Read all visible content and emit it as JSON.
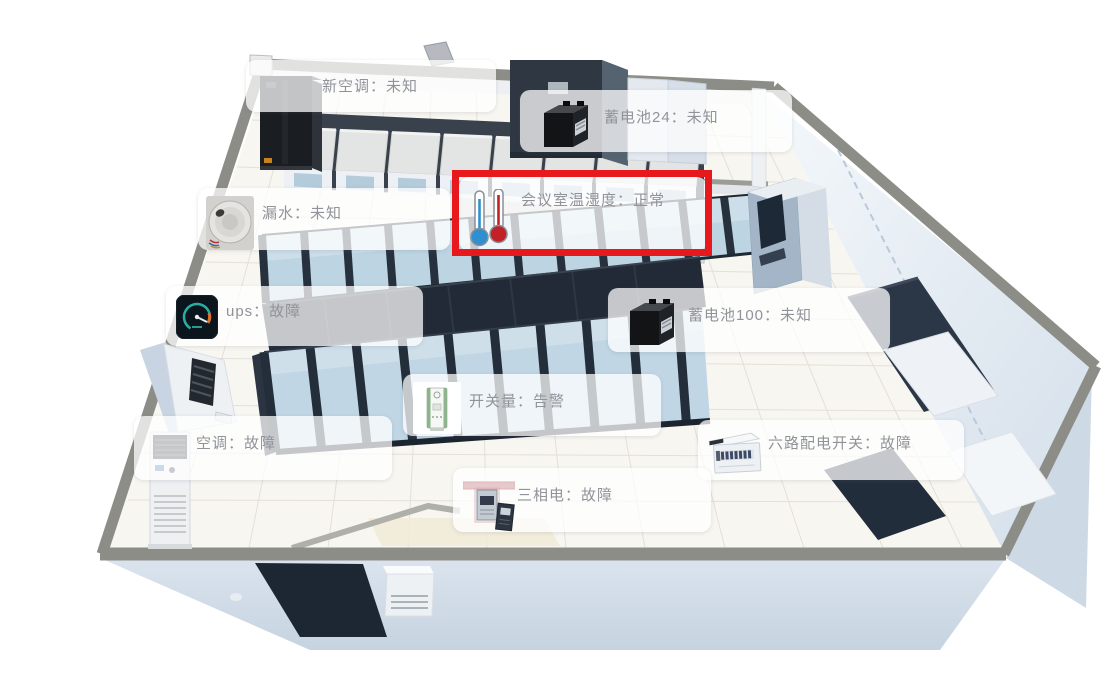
{
  "view": {
    "kind": "machine-room-3d-monitor"
  },
  "colors": {
    "highlight_box": "#e8191c",
    "label_text": "#909399",
    "wall_edge": "#8d8d87",
    "rack_frame": "#27313d",
    "rack_glass": "#bdd4e2",
    "status_normal_thermo_blue": "#2f8fd0",
    "status_normal_thermo_red": "#c22127"
  },
  "highlight": {
    "target": "会议室温湿度",
    "color": "#e8191c"
  },
  "devices": [
    {
      "name": "新空调",
      "status": "未知",
      "label": "新空调：未知",
      "icon": "tower-ac-icon"
    },
    {
      "name": "蓄电池24",
      "status": "未知",
      "label": "蓄电池24：未知",
      "icon": "battery-icon"
    },
    {
      "name": "会议室温湿度",
      "status": "正常",
      "label": "会议室温湿度：正常",
      "icon": "thermometer-pair-icon",
      "highlighted": true
    },
    {
      "name": "漏水",
      "status": "未知",
      "label": "漏水：未知",
      "icon": "leak-sensor-icon"
    },
    {
      "name": "ups",
      "status": "故障",
      "label": "ups：故障",
      "icon": "ups-gauge-icon"
    },
    {
      "name": "蓄电池100",
      "status": "未知",
      "label": "蓄电池100：未知",
      "icon": "battery-icon"
    },
    {
      "name": "开关量",
      "status": "告警",
      "label": "开关量：告警",
      "icon": "io-switch-device-icon"
    },
    {
      "name": "空调",
      "status": "故障",
      "label": "空调：故障",
      "icon": "floor-ac-icon"
    },
    {
      "name": "六路配电开关",
      "status": "故障",
      "label": "六路配电开关：故障",
      "icon": "distribution-box-icon"
    },
    {
      "name": "三相电",
      "status": "故障",
      "label": "三相电：故障",
      "icon": "three-phase-meter-icon"
    }
  ]
}
